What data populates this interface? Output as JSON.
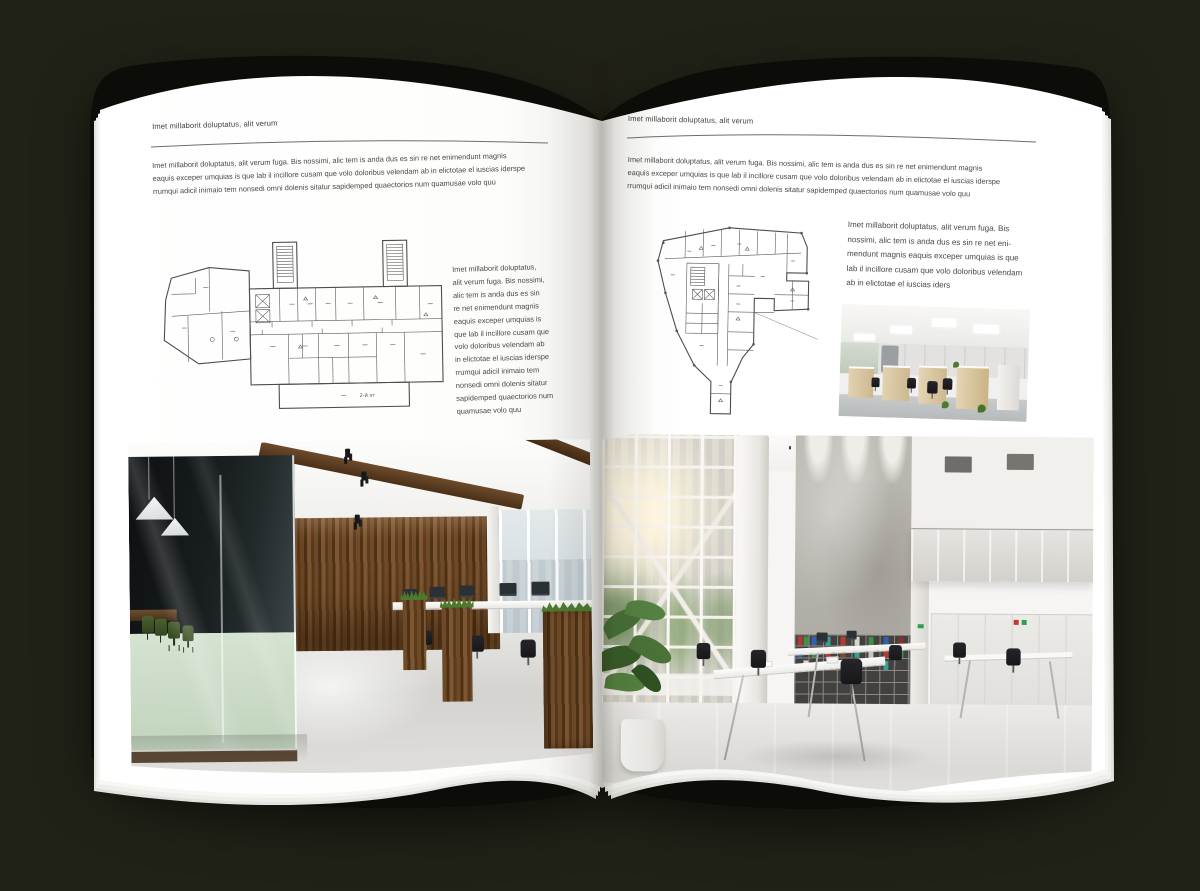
{
  "palette": {
    "background": "#212217",
    "cover": "#0c0c08",
    "page": "#ffffff",
    "body_text": "#474747",
    "hairline": "#6e6e6e",
    "plan_line": "#4d4d4d",
    "wood_accent": "#6f4a29",
    "meeting_chair_green": "#4a612f",
    "binder_red": "#b23c33",
    "binder_green": "#3f8f46",
    "binder_blue": "#2e62ae"
  },
  "left_page": {
    "header": "Imet millaborit doluptatus, alit verum",
    "intro": "Imet millaborit doluptatus, alit verum fuga. Bis nossimi, alic tem is anda dus es sin re net enimendunt magnis\neaquis exceper umquias is que lab il incillore cusam que volo doloribus velendam ab in elictotae el iuscias iderspe\nrrumqui adicil inimaio tem nonsedi omni dolenis sitatur sapidemped quaectorios num quamusae volo quu",
    "floorplan_caption": "2-й эт",
    "side_text": "Imet millaborit doluptatus,\nalit verum fuga. Bis nossimi,\nalic tem is anda dus es sin\nre net enimendunt magnis\neaquis exceper umquias is\nque lab il incillore cusam que\nvolo doloribus velendam ab\nin elictotae el iuscias iderspe\nrrumqui adicil inimaio tem\nnonsedi omni dolenis sitatur\nsapidemped quaectorios num\nquamusae volo quu"
  },
  "right_page": {
    "header": "Imet millaborit doluptatus, alit verum",
    "intro": "Imet millaborit doluptatus, alit verum fuga. Bis nossimi, alic tem is anda dus es sin re net enimendunt magnis\neaquis exceper umquias is que lab il incillore cusam que volo doloribus velendam ab in elictotae el iuscias iderspe\nrrumqui adicil inimaio tem nonsedi omni dolenis sitatur sapidemped quaectorios num quamusae volo quu",
    "side_text": "Imet millaborit doluptatus, alit verum fuga. Bis\nnossimi, alic tem is anda dus es sin re net eni-\nmendunt magnis eaquis exceper umquias is que\nlab il incillore cusam que volo doloribus velendam\nab in elictotae el iuscias iders"
  }
}
